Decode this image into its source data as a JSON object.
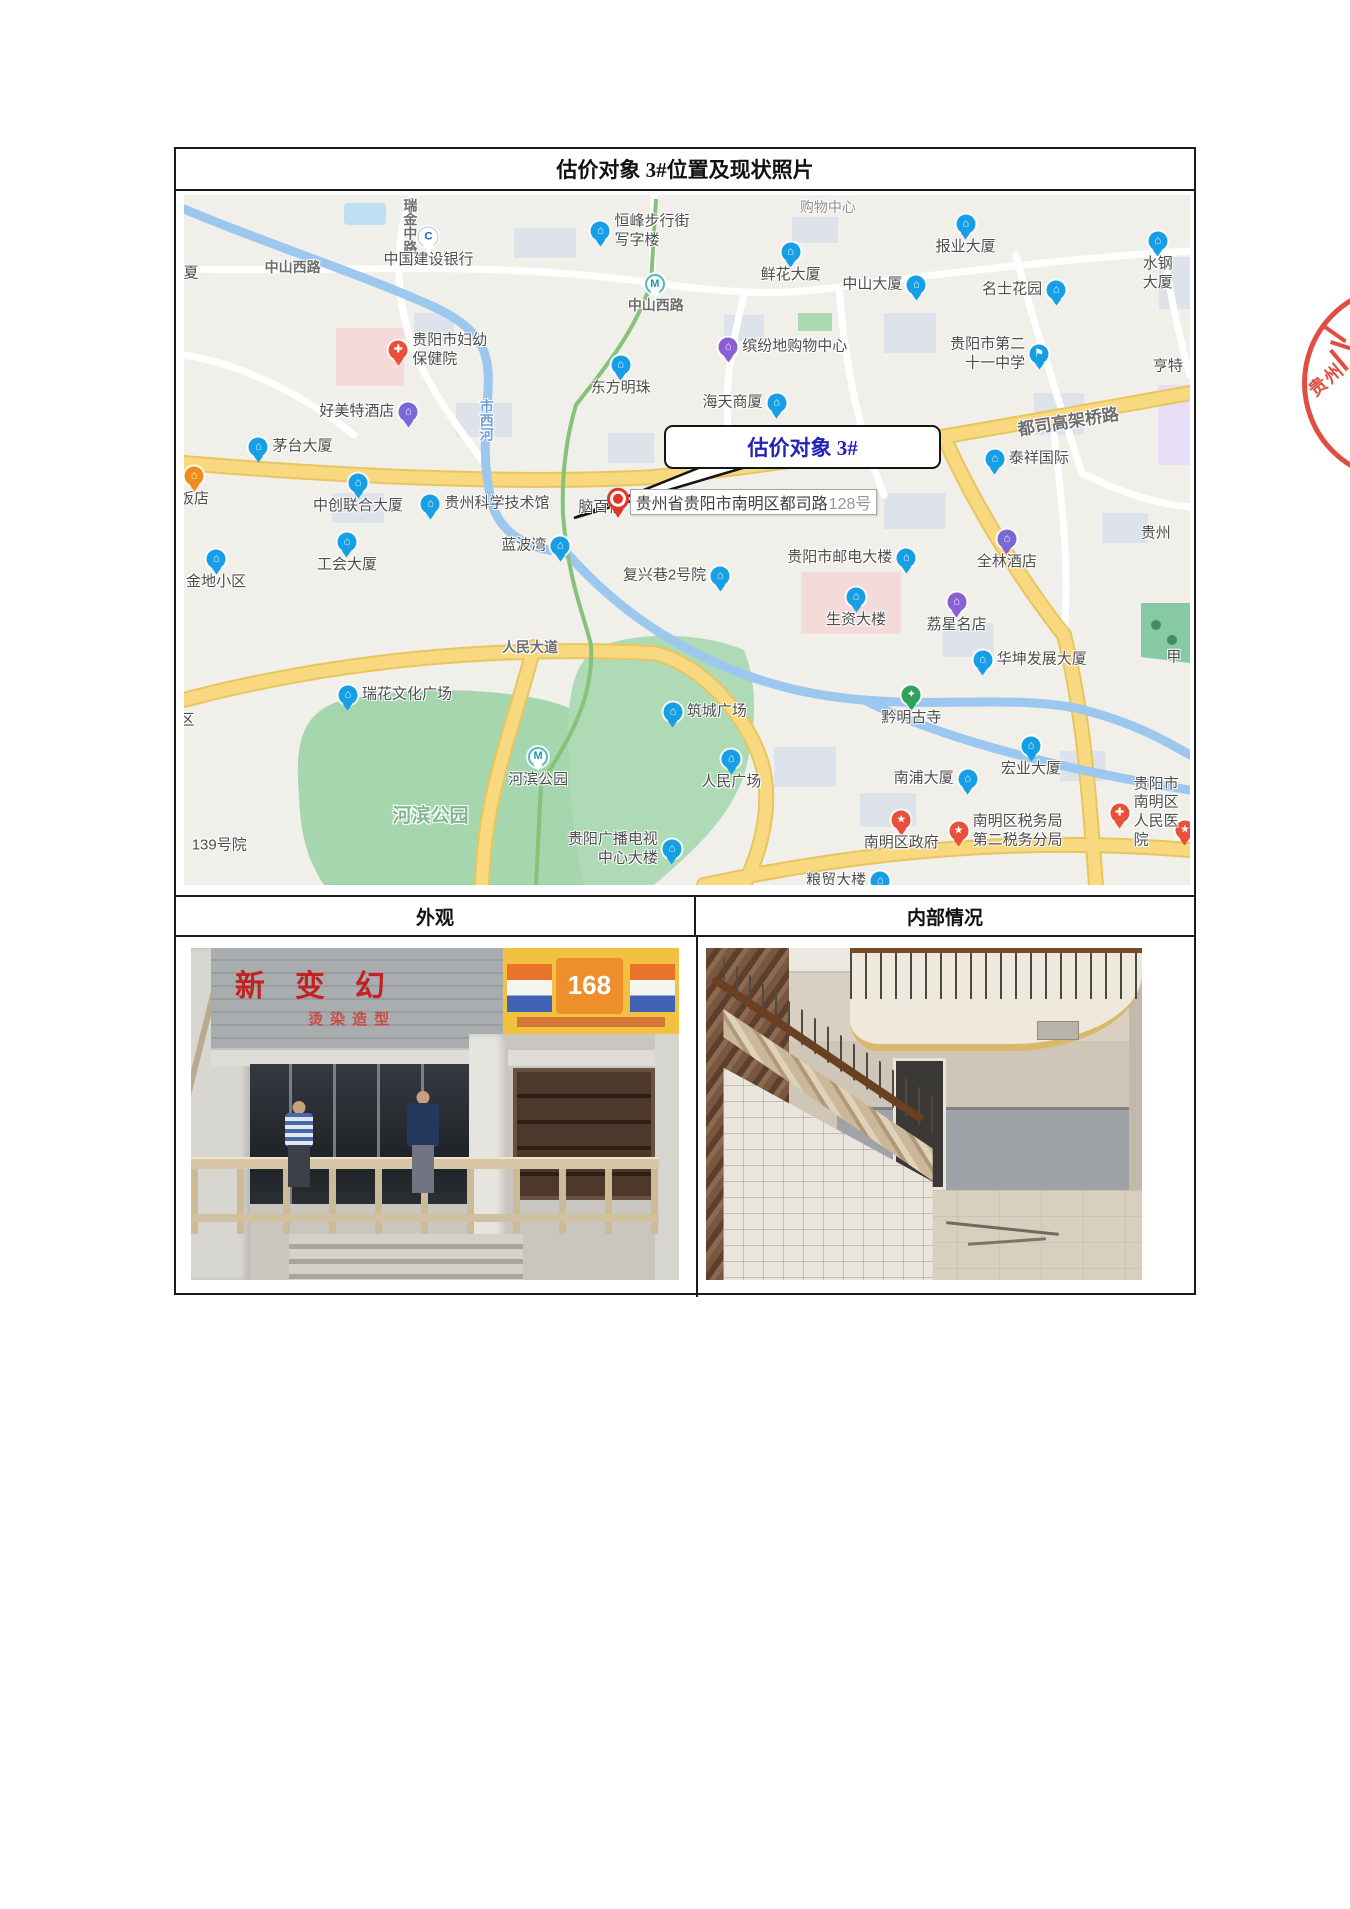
{
  "document": {
    "title": "估价对象 3#位置及现状照片",
    "left_header": "外观",
    "right_header": "内部情况"
  },
  "seal": {
    "text": "贵州"
  },
  "map": {
    "callout": "估价对象 3#",
    "address": {
      "street": "贵州省贵阳市南明区都司路",
      "number": "128号"
    },
    "covered_poi": "脑百信",
    "labels": [
      {
        "text": "中山西路",
        "x": 10.8,
        "y": 10.5
      },
      {
        "text": "瑞金中路",
        "x": 22.5,
        "y": 0.5,
        "vertical": true
      },
      {
        "text": "中山西路",
        "x": 46.9,
        "y": 16.0
      },
      {
        "text": "都司高架桥路",
        "x": 87.9,
        "y": 32.6,
        "rotate": -9,
        "size": 17
      },
      {
        "text": "人民大道",
        "x": 34.4,
        "y": 65.5
      },
      {
        "text": "市西河",
        "x": 30.1,
        "y": 29.5,
        "vertical": true,
        "water": true
      },
      {
        "text": "河滨公园",
        "x": 24.5,
        "y": 89.7,
        "park": true,
        "size": 19
      },
      {
        "text": "购物中心",
        "x": 64.0,
        "y": 1.7,
        "area": true
      },
      {
        "text": "亨特",
        "x": 97.8,
        "y": 24.7,
        "dark": true
      },
      {
        "text": "贵州",
        "x": 96.6,
        "y": 48.8,
        "dark": true
      },
      {
        "text": "甲",
        "x": 98.4,
        "y": 66.8,
        "dark": true
      },
      {
        "text": "夏",
        "x": 0.7,
        "y": 11.2,
        "dark": true
      },
      {
        "text": "区",
        "x": 0.3,
        "y": 76.0,
        "dark": true
      },
      {
        "text": "139号院",
        "x": 3.5,
        "y": 94.0,
        "dark": true
      }
    ],
    "pois": [
      {
        "t": "茅台大厦",
        "x": 7.4,
        "y": 36.5,
        "k": "building",
        "lp": "r"
      },
      {
        "t": "中国建设银行",
        "x": 24.3,
        "y": 6.1,
        "k": "bank",
        "lp": "b"
      },
      {
        "t": "恒峰步行街\n写字楼",
        "x": 41.4,
        "y": 5.2,
        "k": "building",
        "lp": "r"
      },
      {
        "t": "鲜花大厦",
        "x": 60.3,
        "y": 8.3,
        "k": "building",
        "lp": "b"
      },
      {
        "t": "中山大厦",
        "x": 72.8,
        "y": 13.1,
        "k": "building",
        "lp": "l"
      },
      {
        "t": "报业大厦",
        "x": 77.7,
        "y": 4.2,
        "k": "building",
        "lp": "b"
      },
      {
        "t": "名士花园",
        "x": 86.7,
        "y": 13.8,
        "k": "building",
        "lp": "l"
      },
      {
        "t": "水钢大厦",
        "x": 96.8,
        "y": 6.7,
        "k": "building",
        "lp": "b"
      },
      {
        "t": "贵阳市妇幼\n保健院",
        "x": 21.3,
        "y": 22.5,
        "k": "cross",
        "lp": "r"
      },
      {
        "t": "缤纷地购物中心",
        "x": 54.1,
        "y": 22.1,
        "k": "shop",
        "lp": "r"
      },
      {
        "t": "贵阳市第二\n十一中学",
        "x": 85.0,
        "y": 23.1,
        "k": "flag",
        "lp": "l"
      },
      {
        "t": "好美特酒店",
        "x": 22.3,
        "y": 31.4,
        "k": "hotel",
        "lp": "l"
      },
      {
        "t": "东方明珠",
        "x": 43.4,
        "y": 24.7,
        "k": "building",
        "lp": "b"
      },
      {
        "t": "海天商厦",
        "x": 58.9,
        "y": 30.2,
        "k": "building",
        "lp": "l"
      },
      {
        "t": "泰祥国际",
        "x": 80.6,
        "y": 38.2,
        "k": "building",
        "lp": "r"
      },
      {
        "t": "饭店",
        "x": 1.0,
        "y": 40.7,
        "k": "org",
        "lp": "b"
      },
      {
        "t": "中创联合大厦",
        "x": 17.3,
        "y": 41.7,
        "k": "building",
        "lp": "b"
      },
      {
        "t": "贵州科学技术馆",
        "x": 24.5,
        "y": 44.8,
        "k": "building",
        "lp": "r"
      },
      {
        "t": "工会大厦",
        "x": 16.2,
        "y": 50.3,
        "k": "building",
        "lp": "b"
      },
      {
        "t": "金地小区",
        "x": 3.2,
        "y": 52.8,
        "k": "building",
        "lp": "b"
      },
      {
        "t": "蓝波湾",
        "x": 37.4,
        "y": 50.9,
        "k": "building",
        "lp": "l"
      },
      {
        "t": "复兴巷2号院",
        "x": 53.3,
        "y": 55.2,
        "k": "building",
        "lp": "l"
      },
      {
        "t": "贵阳市邮电大楼",
        "x": 71.8,
        "y": 52.6,
        "k": "building",
        "lp": "l"
      },
      {
        "t": "全林酒店",
        "x": 81.8,
        "y": 49.9,
        "k": "hotel",
        "lp": "b"
      },
      {
        "t": "生资大楼",
        "x": 66.8,
        "y": 58.3,
        "k": "building",
        "lp": "b"
      },
      {
        "t": "荔星名店",
        "x": 76.8,
        "y": 59.0,
        "k": "shop",
        "lp": "b"
      },
      {
        "t": "华坤发展大厦",
        "x": 79.4,
        "y": 67.4,
        "k": "building",
        "lp": "r"
      },
      {
        "t": "黔明古寺",
        "x": 72.3,
        "y": 72.4,
        "k": "temple",
        "lp": "b"
      },
      {
        "t": "筑城广场",
        "x": 48.6,
        "y": 74.9,
        "k": "building",
        "lp": "r"
      },
      {
        "t": "人民广场",
        "x": 54.4,
        "y": 81.7,
        "k": "building",
        "lp": "b"
      },
      {
        "t": "南浦大厦",
        "x": 77.9,
        "y": 84.7,
        "k": "building",
        "lp": "l"
      },
      {
        "t": "宏业大厦",
        "x": 84.2,
        "y": 79.9,
        "k": "building",
        "lp": "b"
      },
      {
        "t": "南明区政府",
        "x": 71.3,
        "y": 90.6,
        "k": "star",
        "lp": "b"
      },
      {
        "t": "南明区税务局\n第二税务分局",
        "x": 77.0,
        "y": 92.2,
        "k": "star",
        "lp": "r"
      },
      {
        "t": "贵阳市南明区\n人民医院",
        "x": 93.0,
        "y": 89.5,
        "k": "cross",
        "lp": "r"
      },
      {
        "t": "",
        "x": 99.5,
        "y": 92.0,
        "k": "star",
        "lp": "r"
      },
      {
        "t": "粮贸大楼",
        "x": 69.2,
        "y": 99.4,
        "k": "building",
        "lp": "l"
      },
      {
        "t": "贵阳广播电视\n中心大楼",
        "x": 48.5,
        "y": 94.8,
        "k": "building",
        "lp": "l"
      },
      {
        "t": "瑞花文化广场",
        "x": 16.3,
        "y": 72.4,
        "k": "building",
        "lp": "r"
      },
      {
        "t": "河滨公园",
        "x": 35.2,
        "y": 81.4,
        "k": "metro",
        "lp": "b"
      },
      {
        "t": "",
        "x": 46.8,
        "y": 12.9,
        "k": "metro",
        "lp": "r"
      }
    ]
  },
  "photos": {
    "exterior_sign_main": "新变幻",
    "exterior_sign_sub": "烫染造型",
    "exterior_banner": "168"
  }
}
